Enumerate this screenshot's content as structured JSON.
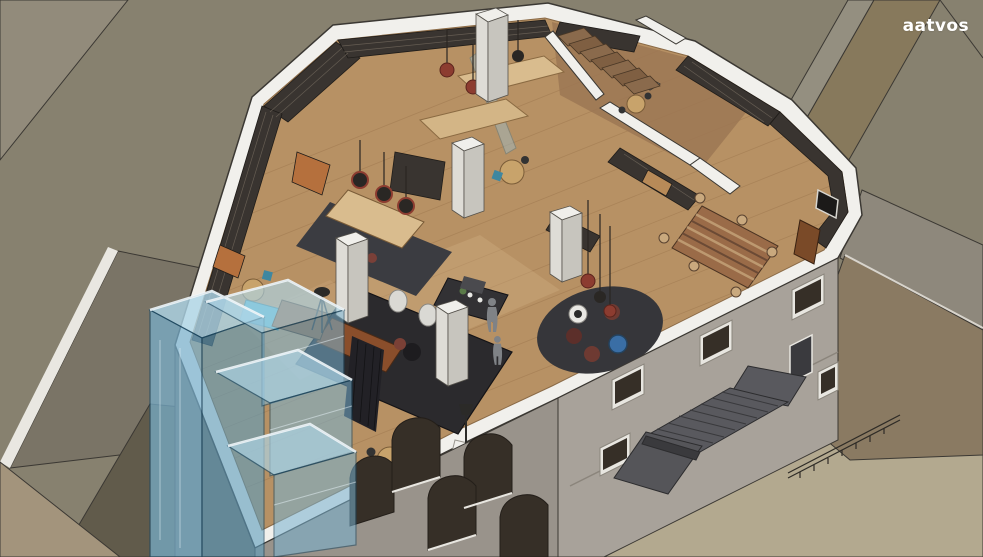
{
  "watermark": {
    "label": "aatvos"
  },
  "scene": {
    "alt": "Isometric cutaway rendering of a library interior with bookshelf walls, reading tables, lounge areas, a glass elevator tower and an external staircase"
  },
  "colors": {
    "roof-base": "#87816f",
    "roof-light": "#928b7b",
    "roof-band-light": "#948f80",
    "roof-band-brown": "#87795c",
    "roof-gray": "#7a7466",
    "roof-dark": "#615b4b",
    "roof-tan": "#a3947c",
    "roof-beige": "#b3a98f",
    "roof-neighbor": "#8e887c",
    "terrace-brown": "#8a7a62",
    "sliver-white": "#e9e7e1",
    "cut-white": "#f1f0ec",
    "facade-left": "#99938b",
    "facade-right": "#a8a29a",
    "facade-side": "#6e6960",
    "window-dark": "#362f27",
    "frame-white": "#e8e6e0",
    "floor-wood": "#b79164",
    "floor-plank": "#a07a50",
    "floor-light": "#cfae80",
    "floor-room-dark": "#9c7753",
    "shelf-dark": "#393430",
    "shelf-wood": "#b78a58",
    "bench-orange": "#b5703d",
    "table-wood": "#d9bc8e",
    "table-round": "#c8a36b",
    "rug-dark": "#3b3c41",
    "stage-dark": "#2b2a2d",
    "sofa-brown": "#8a4e2b",
    "curtain-dark": "#222126",
    "pillar-top": "#f0efeb",
    "pillar-left": "#dedcd6",
    "pillar-right": "#c7c5be",
    "lamp-copper": "#8c3c30",
    "lamp-dark": "#2a2724",
    "pouf-red": "#6e3a32",
    "pouf-red-dark": "#5c2f2a",
    "pouf-blue": "#3a6ea5",
    "chair-teal": "#3f87a0",
    "lounge-teal": "#4fb3c9",
    "meeting-table": "#9a6b48",
    "meeting-stripe": "#c9a97e",
    "meeting-stripe-dark": "#6b4a35",
    "lectern-wood": "#7a4a28",
    "stair-wood": "#8a6a4c",
    "stair-wood-dark": "#7f5f42",
    "stair-gray": "#59595e",
    "stair-gray-dark": "#3a3a3d",
    "glass-top": "#aed6e8",
    "glass-front": "#79b2d0",
    "glass-side": "#5e9dbd",
    "glass-edge": "#1c4861",
    "glass-rim": "#f2f8fb",
    "figure-gray": "#7f8286",
    "line-dark": "#3b3833",
    "screen-dark": "#1c1a19",
    "watermark-white": "#ffffff"
  }
}
